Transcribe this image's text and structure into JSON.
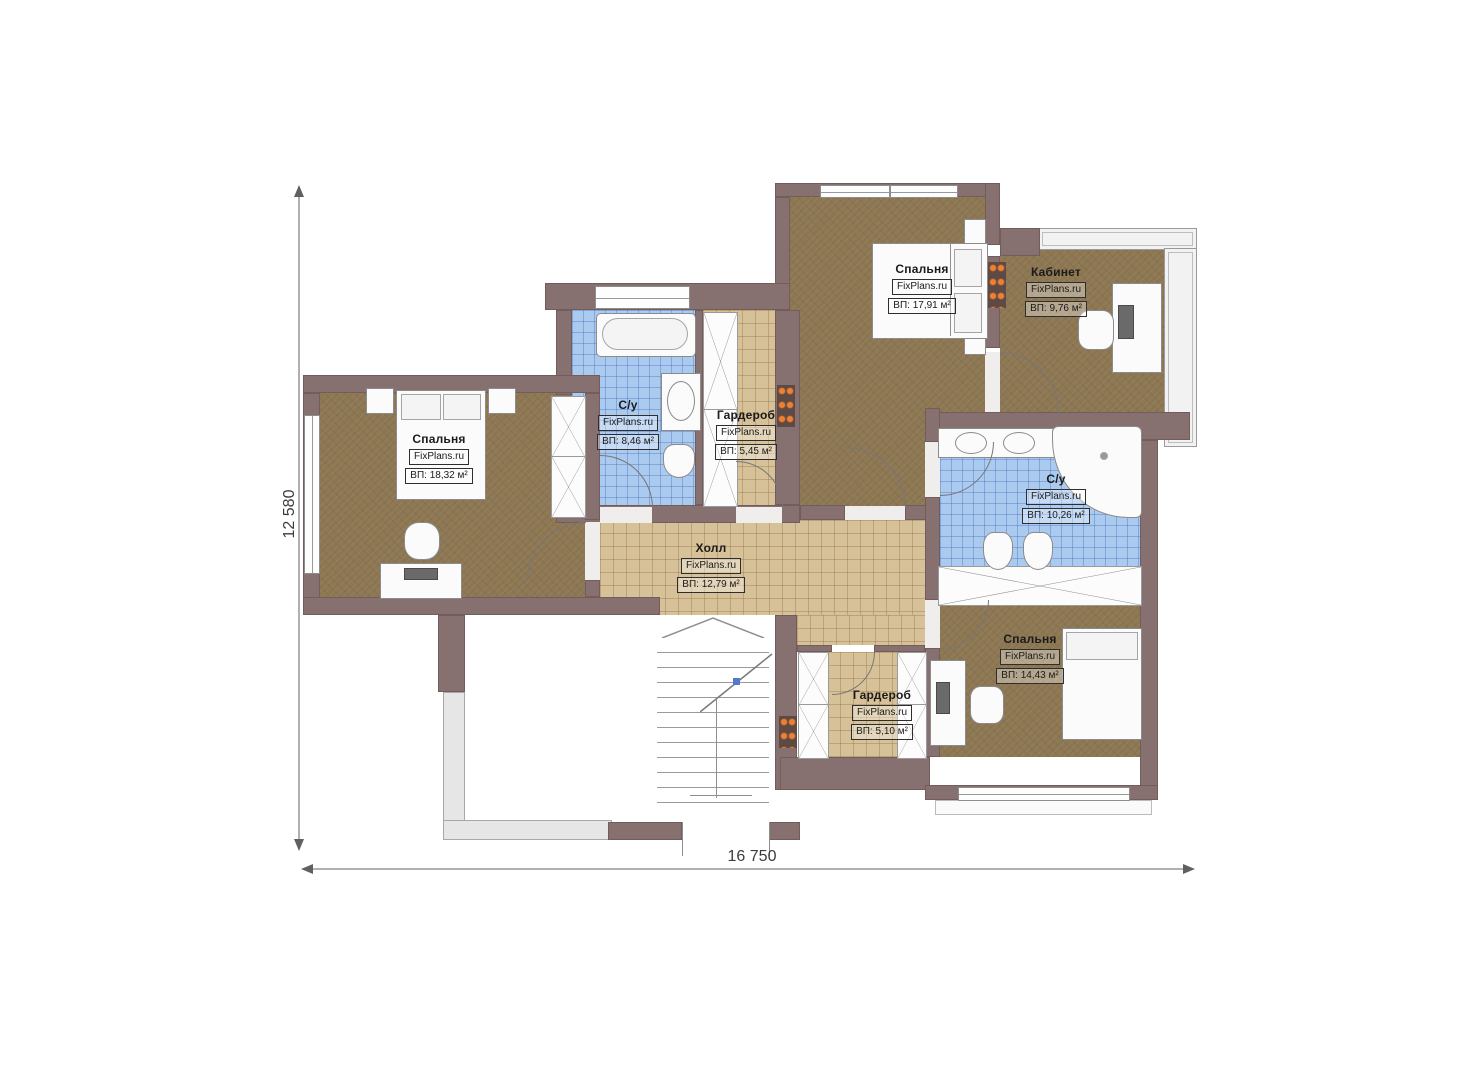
{
  "brand": "FixPlans.ru",
  "plan_type": "second-floor-apartment-plan",
  "dimensions": {
    "width_label": "16 750",
    "height_label": "12 580"
  },
  "rooms": [
    {
      "id": "bedroom-top",
      "name": "Спальня",
      "brand": "FixPlans.ru",
      "area": "ВП: 17,91 м²"
    },
    {
      "id": "office",
      "name": "Кабинет",
      "brand": "FixPlans.ru",
      "area": "ВП: 9,76 м²"
    },
    {
      "id": "bedroom-left",
      "name": "Спальня",
      "brand": "FixPlans.ru",
      "area": "ВП: 18,32 м²"
    },
    {
      "id": "bathroom-top",
      "name": "С/у",
      "brand": "FixPlans.ru",
      "area": "ВП: 8,46 м²"
    },
    {
      "id": "wardrobe-top",
      "name": "Гардероб",
      "brand": "FixPlans.ru",
      "area": "ВП: 5,45 м²"
    },
    {
      "id": "bathroom-right",
      "name": "С/у",
      "brand": "FixPlans.ru",
      "area": "ВП: 10,26 м²"
    },
    {
      "id": "hall",
      "name": "Холл",
      "brand": "FixPlans.ru",
      "area": "ВП: 12,79 м²"
    },
    {
      "id": "bedroom-bottom",
      "name": "Спальня",
      "brand": "FixPlans.ru",
      "area": "ВП: 14,43 м²"
    },
    {
      "id": "wardrobe-bottom",
      "name": "Гардероб",
      "brand": "FixPlans.ru",
      "area": "ВП: 5,10 м²"
    }
  ],
  "colors": {
    "wall": "#877070",
    "floor_wood": "#8d7753",
    "tile_tan": "#d6c198",
    "tile_blue": "#abcaef",
    "radiator_dots": "#f08030"
  }
}
